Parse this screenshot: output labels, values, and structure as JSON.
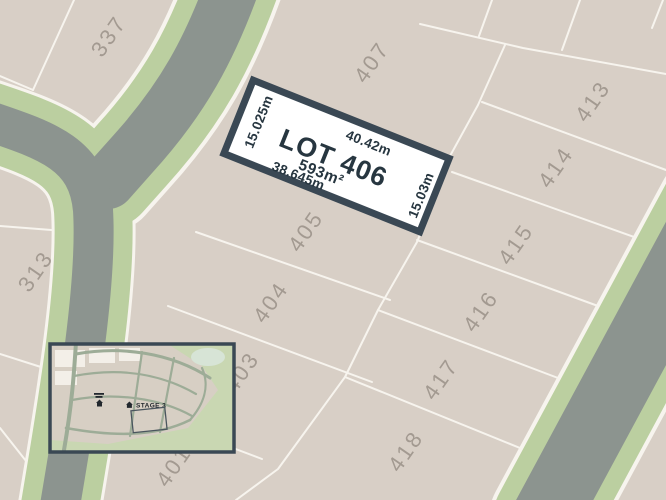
{
  "map": {
    "highlight": {
      "name": "LOT 406",
      "area": "593m²",
      "dim_top": "40.42m",
      "dim_bottom": "38.645m",
      "dim_left": "15.025m",
      "dim_right": "15.03m"
    },
    "lot_numbers": [
      "337",
      "407",
      "413",
      "414",
      "415",
      "416",
      "417",
      "418",
      "405",
      "404",
      "403",
      "401",
      "313"
    ],
    "inset": {
      "stage_label": "STAGE 3"
    },
    "colors": {
      "lot-fill": "#d8cfc6",
      "lot-line": "#f7f4ee",
      "road-gray": "#8c948f",
      "road-green": "#bbcfa0",
      "accent-dark": "#3a4854",
      "label-gray": "#a39a91",
      "text-dark": "#273640",
      "highlight-fill": "#ffffff",
      "inset-bg": "#c9d7b2",
      "inset-beige": "#d7cfc4",
      "inset-road": "#9dac97",
      "inset-white": "#f3efe8",
      "inset-pond": "#d7e4d6",
      "inset-dark": "#22282e"
    }
  }
}
